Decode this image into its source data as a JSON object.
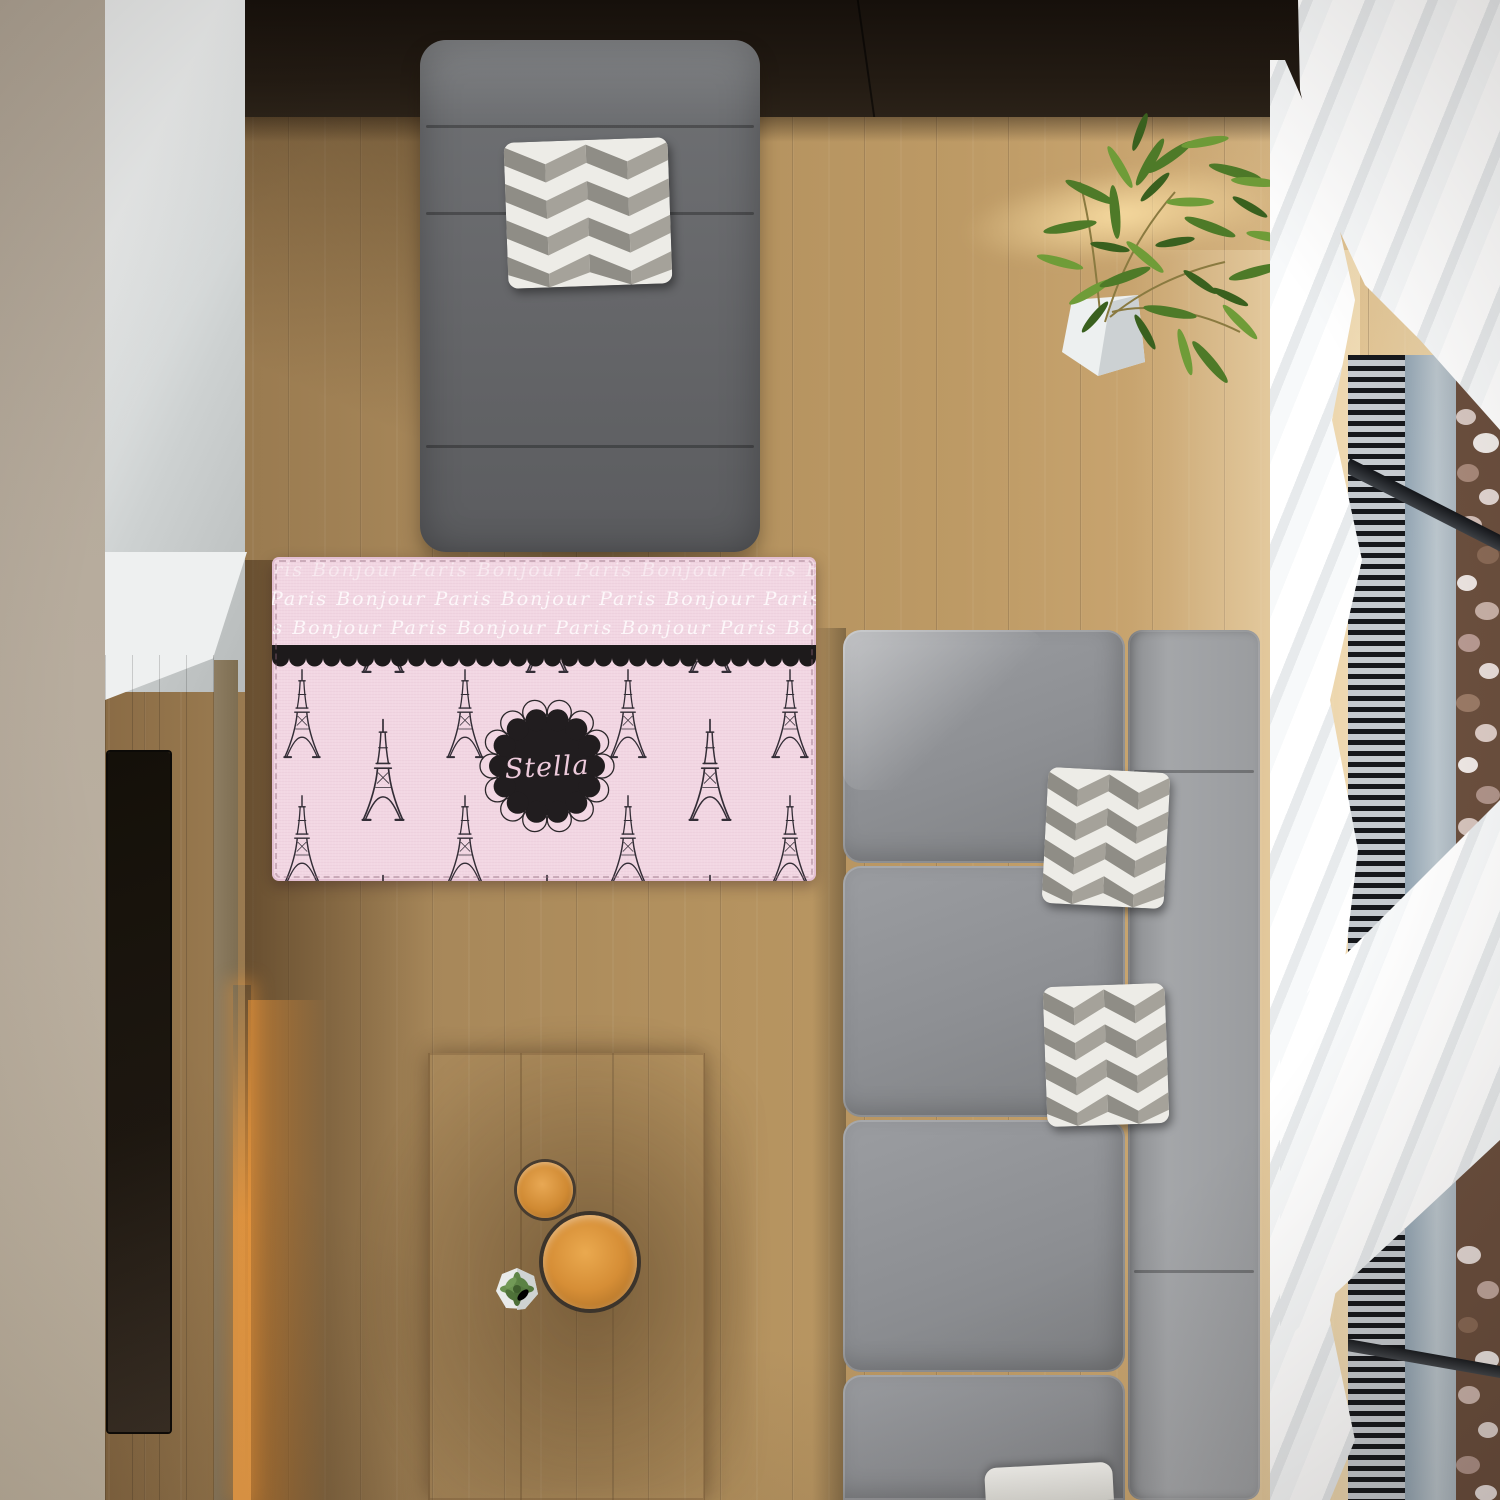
{
  "scene": {
    "title": "Top-down living room with personalized Paris rug",
    "floor_color": "#b08c5c",
    "wall_left_color": "#b6ab9c",
    "wall_back_color": "#d3d6d6",
    "cabinet_color": "#1d150f"
  },
  "rug": {
    "monogram": "Stella",
    "script_word_1": "Paris",
    "script_word_2": "Bonjour",
    "script_row": "Paris Bonjour Paris Bonjour Paris Bonjour Paris Bonjour Paris Bonjour Paris",
    "base_color": "#f2d7e3",
    "band_color": "#1d1a1b",
    "badge_color": "#211d1f",
    "monogram_color": "#edcadb",
    "tower_color": "#332d36",
    "script_color": "#ffffff"
  },
  "furniture": {
    "chair": {
      "label": "gray lounge chair",
      "color": "#6e7073"
    },
    "chair_pillow": {
      "label": "chevron throw pillow",
      "colors": [
        "#edece7",
        "#8f8d86"
      ]
    },
    "sofa": {
      "label": "gray sectional sofa",
      "color": "#8e9093"
    },
    "sofa_pillows": {
      "label": "chevron throw pillows",
      "count": 3
    },
    "coffee_table": {
      "label": "light wood coffee table",
      "color": "#d6c198"
    },
    "tray_small": {
      "label": "small copper tray",
      "color": "#c97f2e"
    },
    "tray_large": {
      "label": "large copper tray",
      "color": "#c97f2e"
    },
    "succulent": {
      "label": "succulent in white pot",
      "color": "#5f7f49"
    },
    "plant": {
      "label": "green plant in white planter",
      "color": "#5a8032"
    },
    "tv": {
      "label": "wall-mounted TV",
      "color": "#16120f"
    },
    "curtains": {
      "label": "white sheer curtains",
      "color": "#f7f9fa"
    },
    "window": {
      "label": "floor window with vent and pebbles",
      "vent_color": "#16181c",
      "glass_color": "#aebcc8",
      "pebbles_color": "#d8cbc6"
    }
  }
}
